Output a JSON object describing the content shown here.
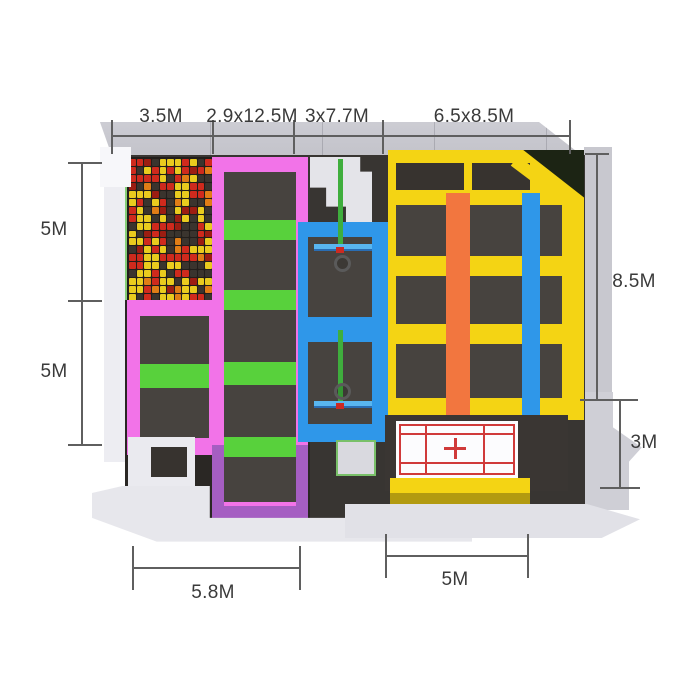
{
  "dims": {
    "top": [
      "3.5M",
      "2.9x12.5M",
      "3x7.7M",
      "6.5x8.5M"
    ],
    "left": [
      "5M",
      "5M"
    ],
    "right": [
      "8.5M",
      "3M"
    ],
    "bottom": [
      "5.8M",
      "5M"
    ]
  },
  "palette": {
    "pink": "#f273e8",
    "green": "#58d13c",
    "blue": "#2f97e9",
    "yellow": "#f4d414",
    "yellow-side": "#b29a10",
    "orange": "#f2763f",
    "purple": "#a55ec2",
    "pad": "#47433f",
    "pad-dark": "#37332f",
    "floor": "#383532",
    "floor-dark": "#2a2724",
    "wall-light": "#ededf2",
    "wall-mid": "#c8c8cf",
    "wall-white": "#f7f7fa",
    "slab": "#e7e7ec",
    "stairs-light": "#eaeaef",
    "landing-gray": "#d9d9df",
    "green-edge": "#86cf78",
    "corner-dark": "#1c2414",
    "mat-white": "#fcfcfe",
    "mat-red": "#d03a3a",
    "hoop-green": "#3fae3d",
    "hoop-board": "#59b6ef",
    "hoop-ring": "#5a5a5a",
    "hoop-tip": "#cc2a22",
    "dim-line": "#5f5f5f",
    "dim-text": "#3a3a3a"
  },
  "foam_pit": {
    "cols": 11,
    "rows": 18,
    "colors": [
      "#cf2a1d",
      "#e9cb1e",
      "#3a342e",
      "#e07d16",
      "#9c1d12"
    ],
    "weights": [
      0.3,
      0.32,
      0.22,
      0.1,
      0.06
    ]
  }
}
